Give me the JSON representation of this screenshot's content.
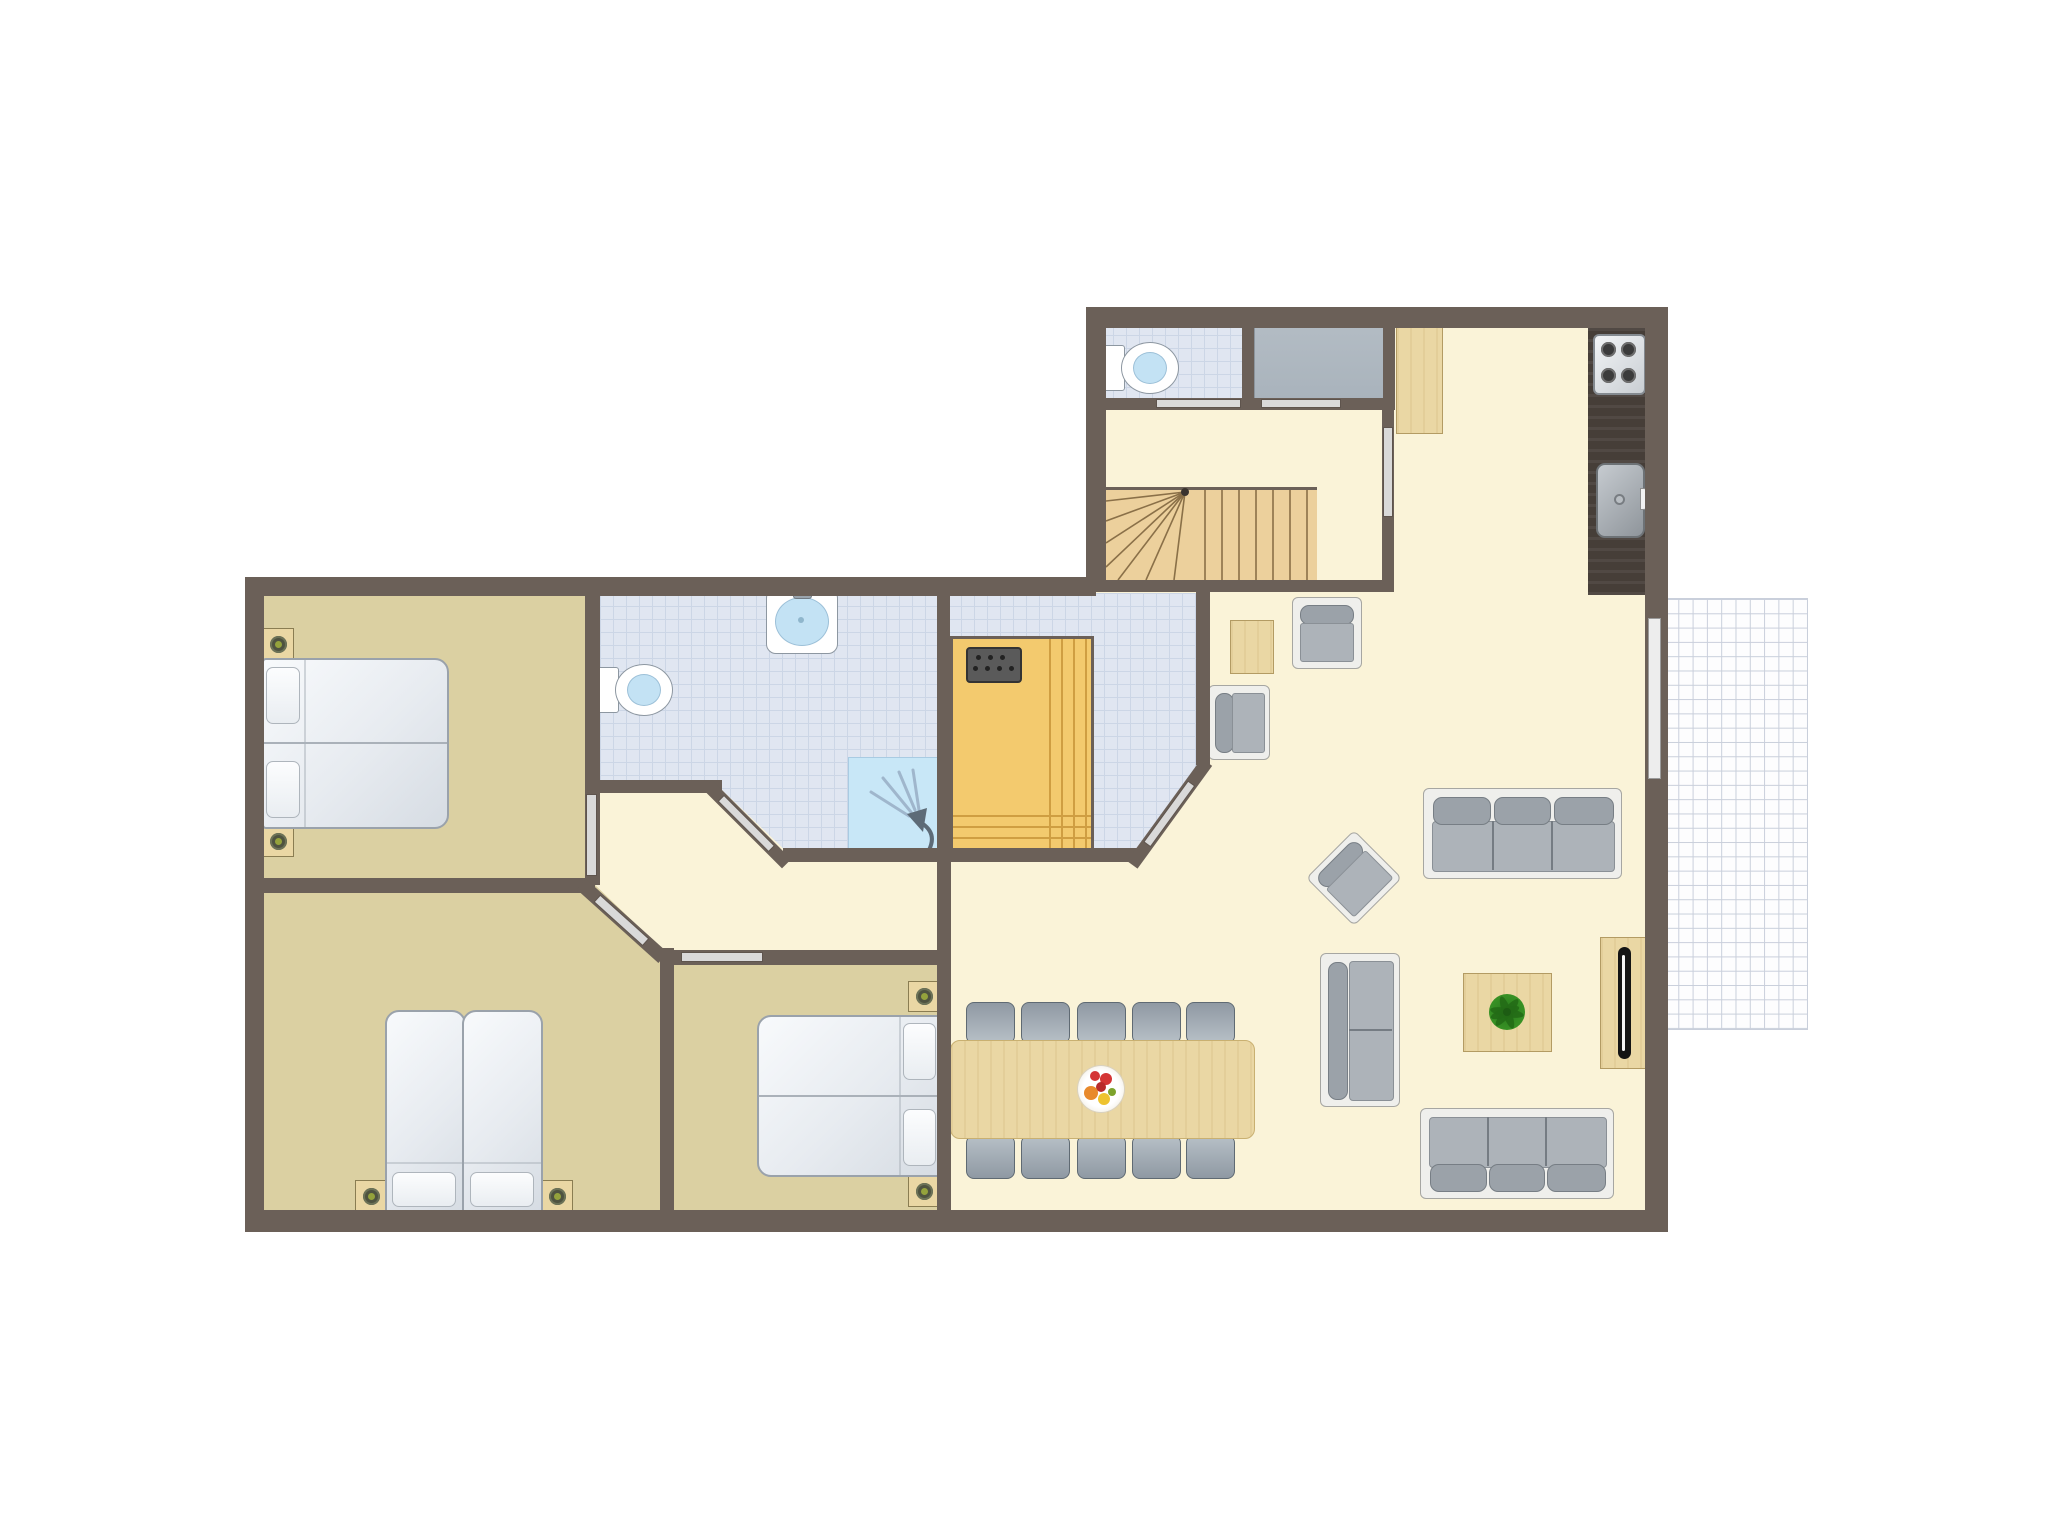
{
  "palette": {
    "white": "#ffffff",
    "wall": "#6b6058",
    "cream": "#faf3d8",
    "tan": "#dbd0a2",
    "tile": "#e0e6f1",
    "tileLine": "#ccd6e6",
    "terraceLine": "#c9cfdb",
    "wood": "#ecd09c",
    "woodLine": "#8a7048",
    "saunaWood": "#f3ca6e",
    "saunaStripe": "#cf9e42",
    "counter": "#463e38",
    "gray": "#a9b3bc",
    "doorColor": "#d9d9d9",
    "windowColor": "#ededed",
    "basin": "#c3e2f4",
    "shower": "#c8e7f7",
    "frame": "#efefec",
    "sofaFill": "#adb3b9",
    "sofaDark": "#9ba2a9",
    "furnWood": "#ead7a4",
    "lampOuter": "#4f5340",
    "lampInner": "#94a23c",
    "plantGreen": "#3f9b28",
    "plantDark": "#246c16",
    "fruitRed": "#d43535",
    "fruitOrange": "#e8892b",
    "fruitYellow": "#eec32f"
  },
  "rooms": {
    "hall": {
      "label": "Entrance hall with winder staircase"
    },
    "wc": {
      "label": "Separate WC"
    },
    "storage": {
      "label": "Storage closet"
    },
    "kitchen": {
      "label": "Open kitchen with counter, 4-burner stove and sink"
    },
    "living": {
      "label": "Living / dining room"
    },
    "bathroom": {
      "label": "Bathroom with toilet, washbasin and shower"
    },
    "sauna": {
      "label": "Sauna room with wooden sauna and heater"
    },
    "bedroom1": {
      "label": "Bedroom 1 - double bed"
    },
    "bedroom2": {
      "label": "Bedroom 2 - two single beds"
    },
    "bedroom3": {
      "label": "Bedroom 3 - double bed"
    },
    "corridor": {
      "label": "Corridor to bedrooms"
    },
    "terrace": {
      "label": "Terrace / balcony (tiled grid)"
    }
  },
  "fixtures": {
    "stove_burners": 4,
    "toilets": 2,
    "washbasins": 1,
    "showers": 1,
    "kitchen_sinks": 1,
    "sauna_heater_dots": 7,
    "stairs_type": "winder"
  },
  "furniture": {
    "dining_chairs": 10,
    "dining_table": {
      "label": "Dining table with fruit bowl"
    },
    "sofas_3seat": 2,
    "sofas_2seat": 1,
    "armchairs": 3,
    "side_tables": 1,
    "coffee_table": {
      "label": "Coffee table with plant"
    },
    "tv_sideboard": {
      "label": "TV sideboard"
    },
    "wardrobe": {
      "label": "Wardrobe next to stairs"
    },
    "double_beds": 2,
    "single_beds": 2,
    "nightstands": 6,
    "nightstand_lamps": 6
  }
}
